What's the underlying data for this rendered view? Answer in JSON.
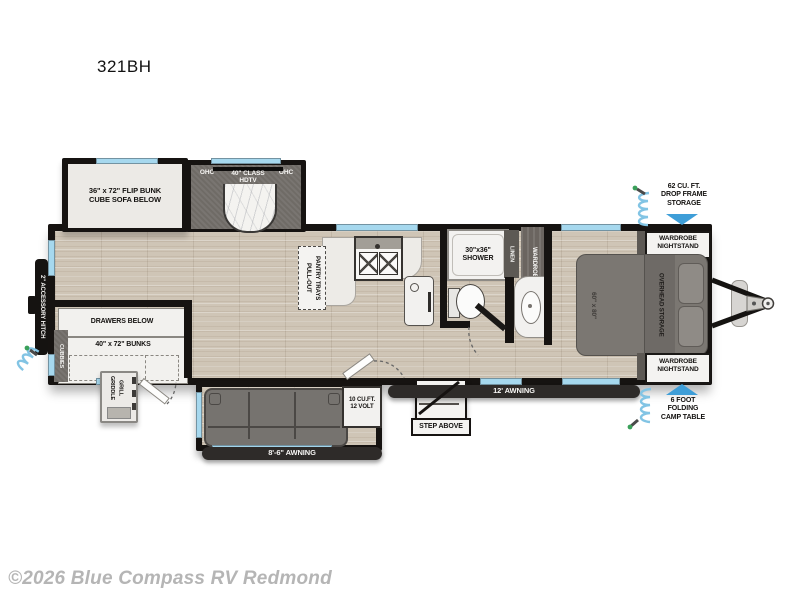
{
  "title": "321BH",
  "footer": {
    "copyright": "©2026 Blue Compass RV Redmond"
  },
  "colors": {
    "window_blue": "#a6d8ee",
    "arrow_blue": "#3e9ed8",
    "coil_blue": "#82c4e4",
    "wall_black": "#161311",
    "floor_tan": "#cfc5b6",
    "awning_bar": "#2e2b29"
  },
  "plan": {
    "model": "321BH",
    "slide_front": {
      "line1": "36\" x 72\" FLIP BUNK",
      "line2": "CUBE SOFA BELOW"
    },
    "entertainment": {
      "ohc": "OHC",
      "tv_line1": "40\" CLASS",
      "tv_line2": "HDTV"
    },
    "bunk_room": {
      "cubbies": "CUBBIES",
      "drawers": "DRAWERS BELOW",
      "bunks": "40\" x 72\" BUNKS"
    },
    "kitchen": {
      "pantry_line1": "PULL-OUT",
      "pantry_line2": "PANTRY TRAYS",
      "fridge_line1": "10 CU.FT.",
      "fridge_line2": "12 VOLT"
    },
    "bath": {
      "shower_line1": "30\"x36\"",
      "shower_line2": "SHOWER",
      "linen": "LINEN",
      "wardrobe": "WARDROBE"
    },
    "bedroom": {
      "bed_size": "60\" x 80\"",
      "overhead": "OVERHEAD STORAGE",
      "nightstand_line1": "WARDROBE",
      "nightstand_line2": "NIGHTSTAND"
    },
    "exterior": {
      "accessory_hitch": "2\" ACCESSORY HITCH",
      "storage_line1": "62 CU. FT.",
      "storage_line2": "DROP FRAME",
      "storage_line3": "STORAGE",
      "camp_table_line1": "6 FOOT",
      "camp_table_line2": "FOLDING",
      "camp_table_line3": "CAMP TABLE",
      "awning_main": "12' AWNING",
      "awning_rear": "8'-6\" AWNING",
      "step": "STEP ABOVE",
      "griddle_line1": "GRIDDLE",
      "griddle_line2": "GRILL"
    }
  }
}
